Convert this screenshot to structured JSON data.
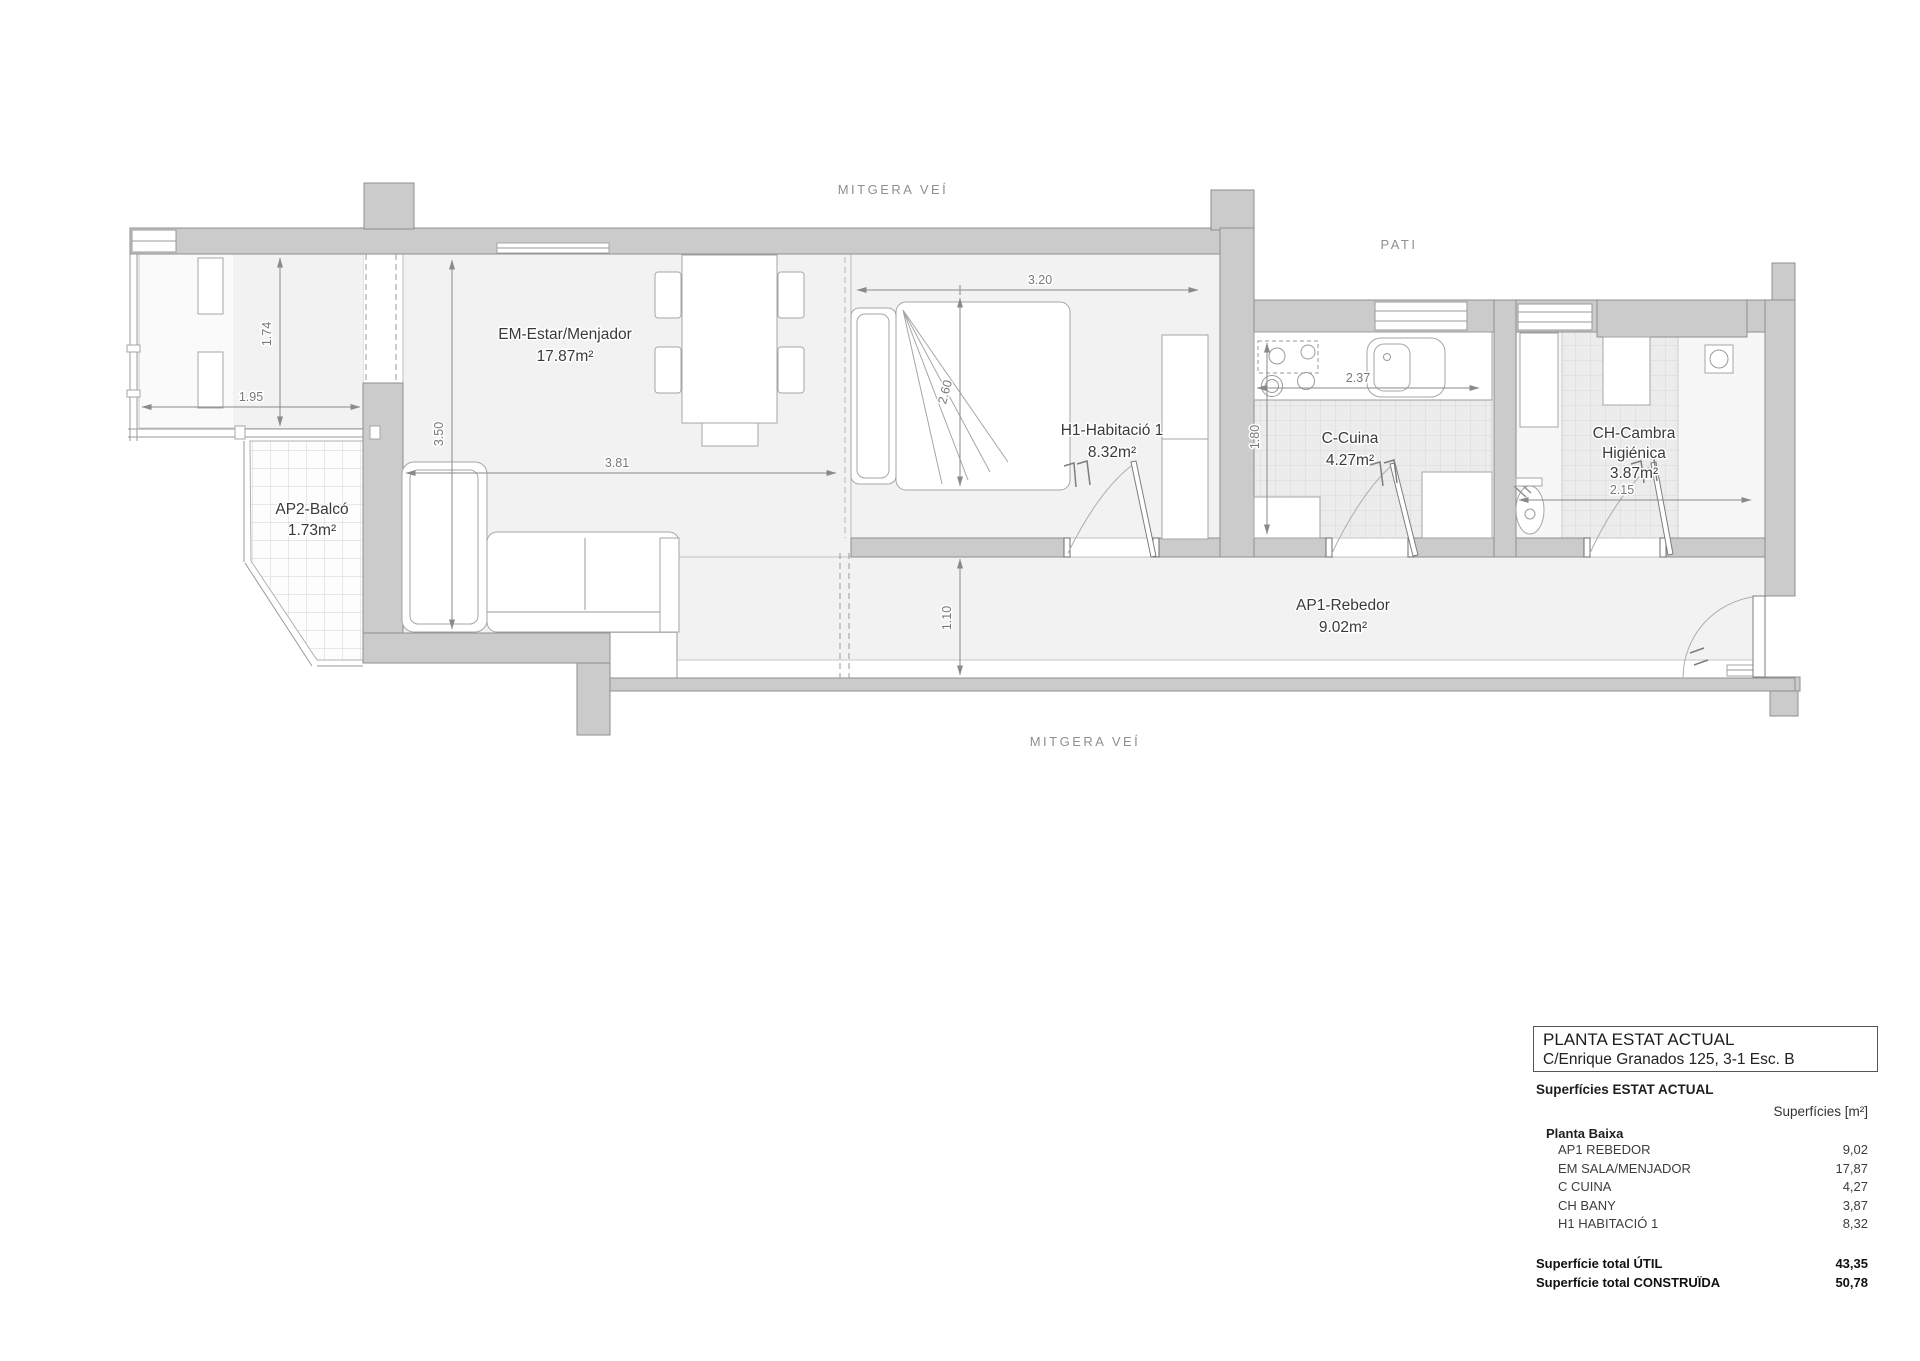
{
  "plan": {
    "party_wall_top": "MITGERA VEÍ",
    "party_wall_bottom": "MITGERA VEÍ",
    "courtyard": "PATI",
    "rooms": [
      {
        "name": "EM-Estar/Menjador",
        "area": "17.87m²"
      },
      {
        "name": "H1-Habitació 1",
        "area": "8.32m²"
      },
      {
        "name": "C-Cuina",
        "area": "4.27m²"
      },
      {
        "name": "CH-Cambra",
        "name2": "Higiénica",
        "area": "3.87m²"
      },
      {
        "name": "AP1-Rebedor",
        "area": "9.02m²"
      },
      {
        "name": "AP2-Balcó",
        "area": "1.73m²"
      }
    ],
    "dims": {
      "balcony_depth": "1.74",
      "balcony_width": "1.95",
      "living_depth": "3.50",
      "living_width": "3.81",
      "bedroom_width": "3.20",
      "bedroom_depth": "2.60",
      "hall_depth": "1.10",
      "kitchen_depth": "1.80",
      "kitchen_width": "2.37",
      "bath_width": "2.15"
    }
  },
  "title_block": {
    "title": "PLANTA ESTAT ACTUAL",
    "address": "C/Enrique Granados 125, 3-1 Esc. B"
  },
  "surface_table": {
    "heading": "Superfícies ESTAT ACTUAL",
    "unit_header": "Superfícies [m²]",
    "group": "Planta Baixa",
    "rows": [
      {
        "label": "AP1 REBEDOR",
        "value": "9,02"
      },
      {
        "label": "EM SALA/MENJADOR",
        "value": "17,87"
      },
      {
        "label": "C CUINA",
        "value": "4,27"
      },
      {
        "label": "CH BANY",
        "value": "3,87"
      },
      {
        "label": "H1 HABITACIÓ 1",
        "value": "8,32"
      }
    ],
    "totals": [
      {
        "label": "Superfície total ÚTIL",
        "value": "43,35"
      },
      {
        "label": "Superfície total CONSTRUÏDA",
        "value": "50,78"
      }
    ]
  }
}
